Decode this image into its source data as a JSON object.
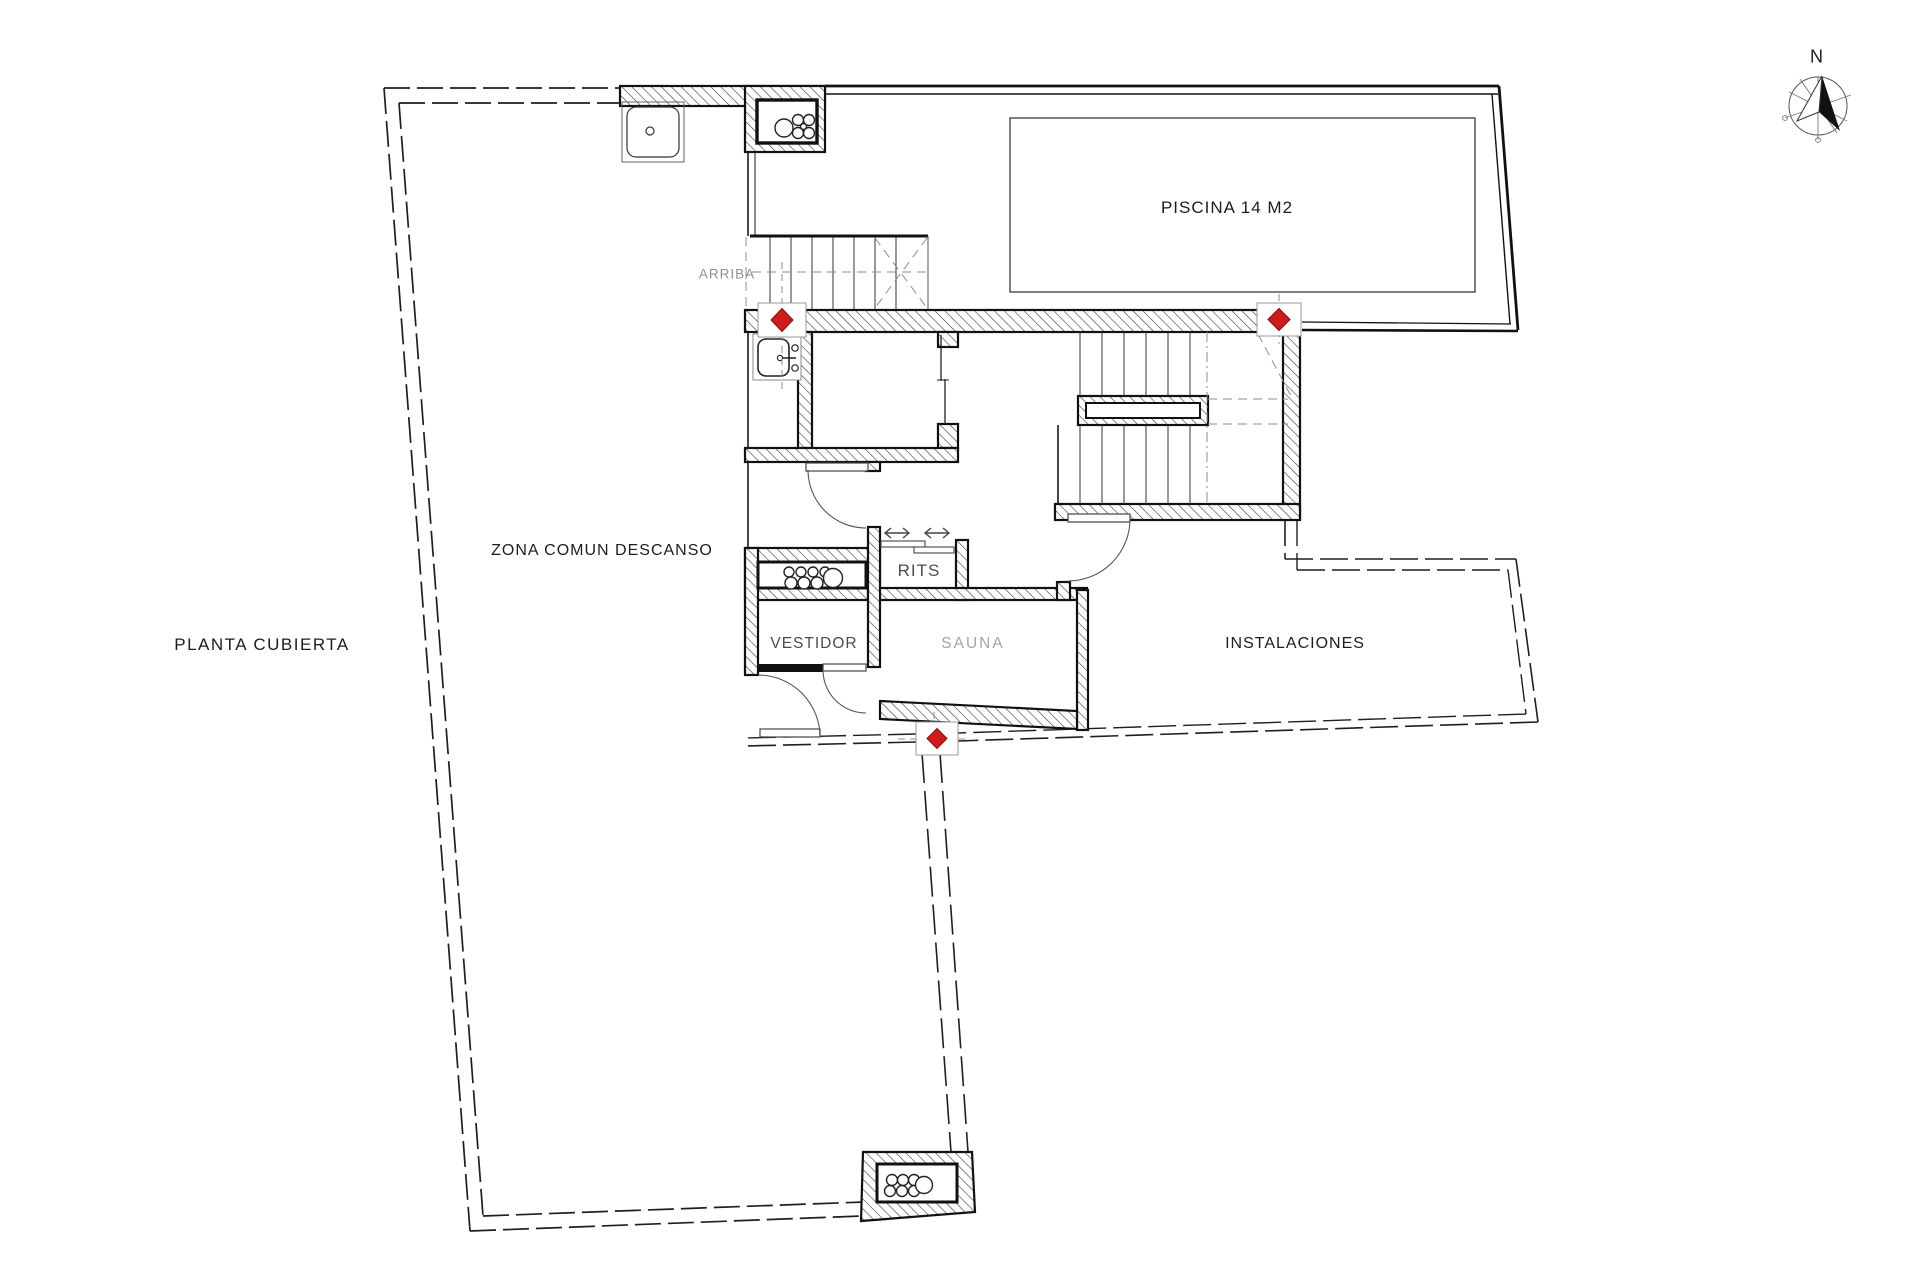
{
  "drawing": {
    "title": "PLANTA CUBIERTA",
    "labels": {
      "plan_title": "PLANTA CUBIERTA",
      "zona_comun": "ZONA COMUN DESCANSO",
      "piscina": "PISCINA 14 M2",
      "arriba": "ARRIBA",
      "rits": "RITS",
      "vestidor": "VESTIDOR",
      "sauna": "SAUNA",
      "instalaciones": "INSTALACIONES",
      "north": "N"
    },
    "colors": {
      "line": "#1a1a1a",
      "muted_line": "#8c8c8c",
      "marker_red": "#d11a1a",
      "background": "#ffffff"
    },
    "icons": [
      "north-compass-icon",
      "valve-marker-icon",
      "sink-icon",
      "shower-tray-icon",
      "pipe-bundle-icon",
      "stairs-icon",
      "door-swing-icon",
      "sliding-door-arrow-icon"
    ]
  }
}
